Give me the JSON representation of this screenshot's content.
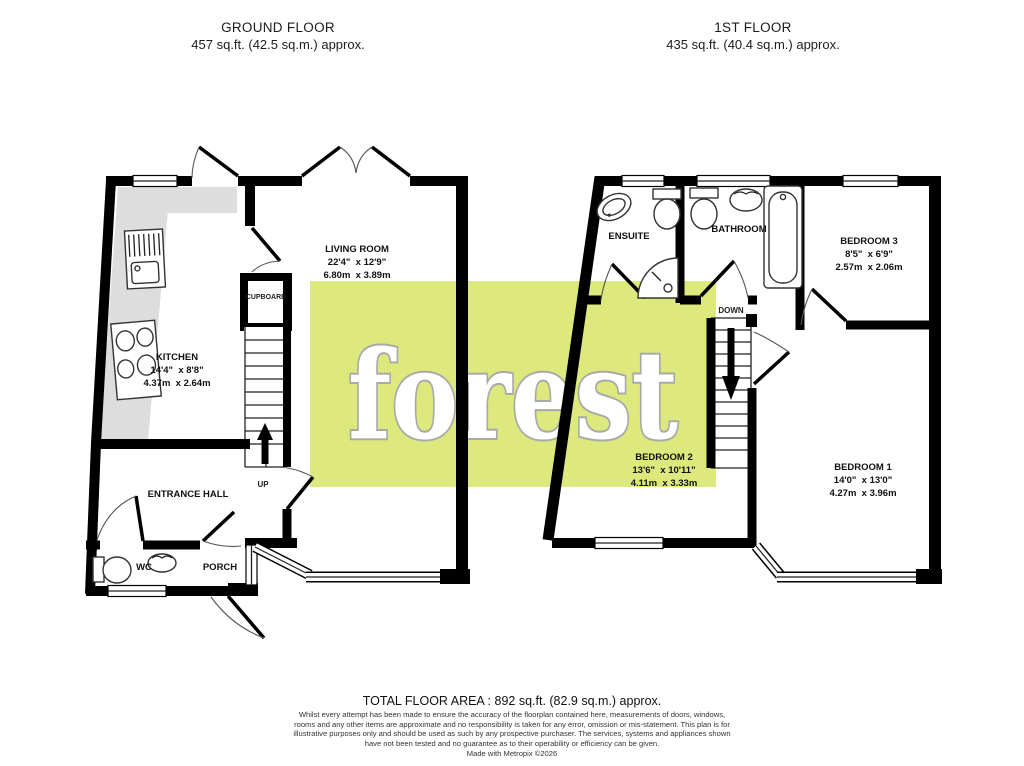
{
  "header": {
    "ground_floor": {
      "title": "GROUND FLOOR",
      "area": "457 sq.ft. (42.5 sq.m.) approx."
    },
    "first_floor": {
      "title": "1ST FLOOR",
      "area": "435 sq.ft. (40.4 sq.m.) approx."
    }
  },
  "ground_floor": {
    "rooms": {
      "kitchen": {
        "name": "KITCHEN",
        "imperial": "14'4\"  x 8'8\"",
        "metric": "4.37m  x 2.64m"
      },
      "living_room": {
        "name": "LIVING ROOM",
        "imperial": "22'4\"  x 12'9\"",
        "metric": "6.80m  x 3.89m"
      },
      "entrance_hall": {
        "name": "ENTRANCE HALL"
      },
      "wc": {
        "name": "WC"
      },
      "porch": {
        "name": "PORCH"
      },
      "cupboard": {
        "name": "CUPBOARD"
      }
    },
    "stairs_label": "UP"
  },
  "first_floor": {
    "rooms": {
      "ensuite": {
        "name": "ENSUITE"
      },
      "bathroom": {
        "name": "BATHROOM"
      },
      "bedroom1": {
        "name": "BEDROOM 1",
        "imperial": "14'0\"  x 13'0\"",
        "metric": "4.27m  x 3.96m"
      },
      "bedroom2": {
        "name": "BEDROOM 2",
        "imperial": "13'6\"  x 10'11\"",
        "metric": "4.11m  x 3.33m"
      },
      "bedroom3": {
        "name": "BEDROOM 3",
        "imperial": "8'5\"  x 6'9\"",
        "metric": "2.57m  x 2.06m"
      }
    },
    "stairs_label": "DOWN"
  },
  "watermark": {
    "text": "forest",
    "background": "#dde87d",
    "outline": "#a9a9a9"
  },
  "footer": {
    "total_area": "TOTAL FLOOR AREA : 892 sq.ft. (82.9 sq.m.) approx.",
    "disclaimer": "Whilst every attempt has been made to ensure the accuracy of the floorplan contained here, measurements of doors, windows, rooms and any other items are approximate and no responsibility is taken for any error, omission or mis-statement. This plan is for illustrative purposes only and should be used as such by any prospective purchaser. The services, systems and appliances shown have not been tested and no guarantee as to their operability or efficiency can be given.",
    "credit": "Made with Metropix ©2026"
  }
}
